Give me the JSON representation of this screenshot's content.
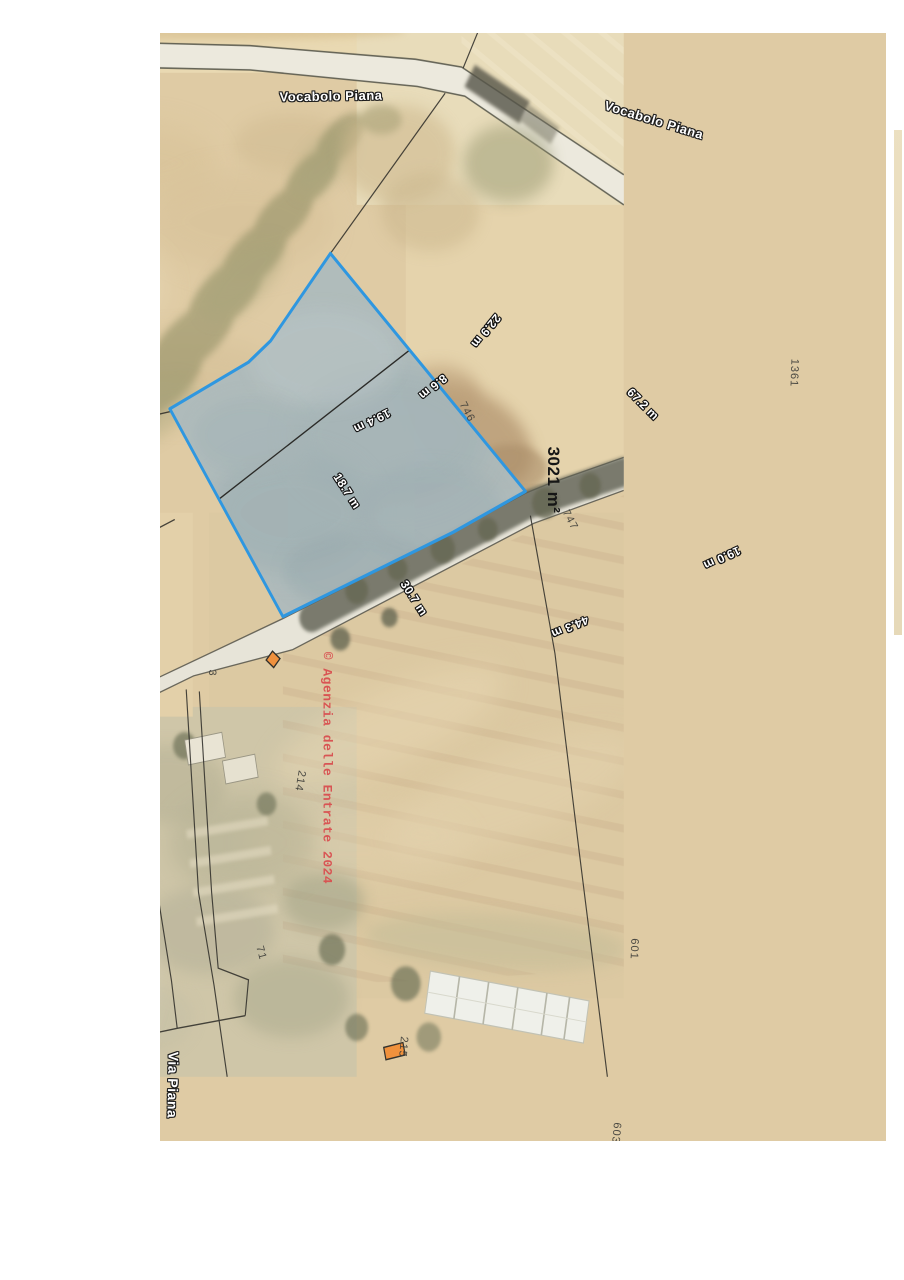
{
  "map": {
    "road_labels": [
      {
        "text": "Vocabolo Piana"
      },
      {
        "text": "Vocabolo Piana"
      },
      {
        "text": "Via Piana"
      }
    ],
    "watermark": {
      "text": "© Agenzia delle Entrate 2024",
      "color": "#d94f50"
    },
    "highlighted_parcel": {
      "area_label": "3021 m²",
      "border_color": "#2f97e0",
      "fill_color": "#adbabd",
      "sub_parcels": [
        {
          "number": "746"
        },
        {
          "number": "747"
        }
      ],
      "measurements": [
        {
          "text": "22.9 m"
        },
        {
          "text": "8.6 m"
        },
        {
          "text": "19.4 m"
        },
        {
          "text": "18.7 m"
        },
        {
          "text": "30.7 m"
        },
        {
          "text": "44.3 m"
        },
        {
          "text": "19.0 m"
        },
        {
          "text": "67.2 m"
        }
      ]
    },
    "parcel_numbers": [
      {
        "number": "1361"
      },
      {
        "number": "3"
      },
      {
        "number": "214"
      },
      {
        "number": "71"
      },
      {
        "number": "215"
      },
      {
        "number": "601"
      },
      {
        "number": "603"
      }
    ],
    "colors": {
      "field_tan": "#dfcba4",
      "road_light": "#ece9dd",
      "building_orange": "#f0913c",
      "shadow_olive": "#5f6153",
      "parcel_blue_border": "#2f97e0"
    }
  }
}
